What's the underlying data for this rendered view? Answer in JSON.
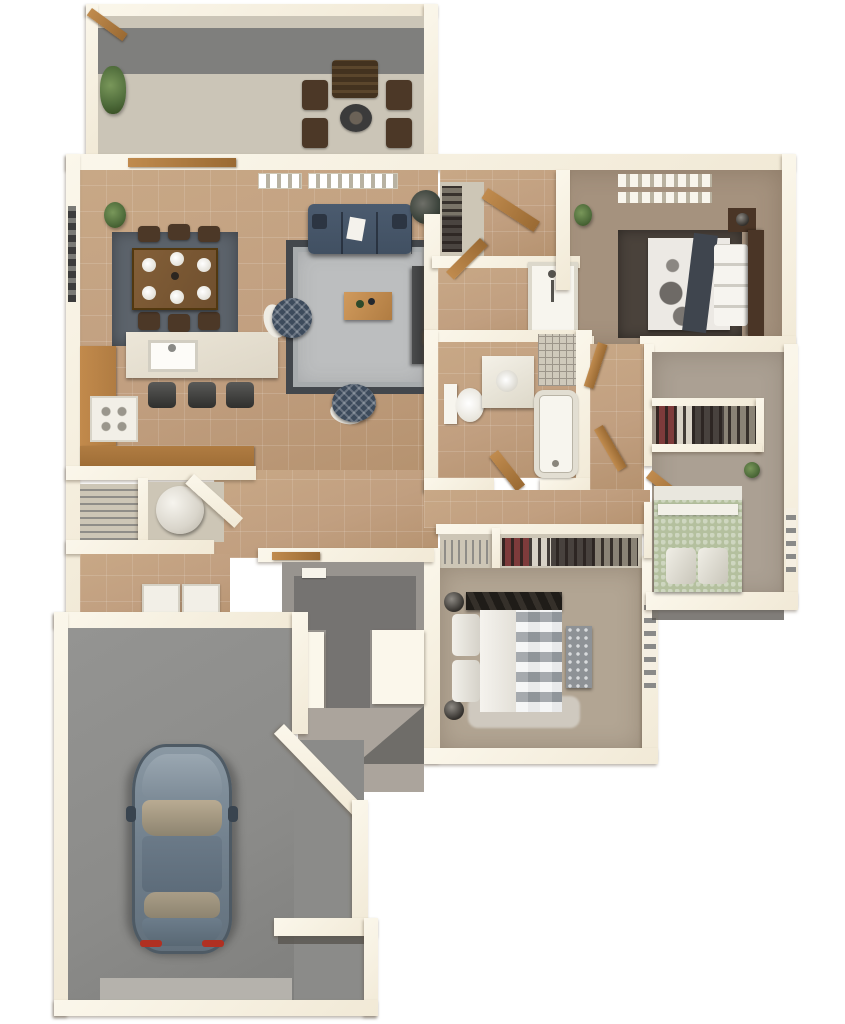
{
  "meta": {
    "kind": "3d-floor-plan-render",
    "view": "top-down isometric",
    "text_visible_on_image": "none"
  },
  "palette": {
    "wall": "#f1e9d6",
    "wall_hi": "#fbf7eb",
    "tile": "#c19f80",
    "rug_dining": "#5c636b",
    "table_wood": "#6f4f2e",
    "rug_living": "#bcbebf",
    "rug_living_border": "#43474c",
    "sofa": "#415062",
    "ottoman": "#3d4b5c",
    "counter_wood": "#b07c42",
    "island": "#ddd6c6",
    "carpet_master": "#a5927e",
    "rug_master": "#4a423b",
    "bed_frame": "#4a3526",
    "carpet_bed2": "#b2a593",
    "carpet_bed3": "#aba093",
    "bed_green": "#b4c09e",
    "bath_white": "#f7f5ee",
    "garage_floor": "#8b8b89",
    "garage_apron": "#b5b2ac",
    "porch": "#98948f",
    "porch_dark": "#757371",
    "porch_slab": "#aba49c",
    "patio": "#cbc5b7",
    "patio_band": "#7f7f7d",
    "car_body": "#73828f",
    "car_glass": "#b9ab92",
    "plant": "#4e6b3a"
  },
  "rooms": [
    {
      "id": "patio",
      "name": "Rear patio",
      "furniture": [
        "outdoor-chair x4",
        "outdoor-loveseat",
        "fire-pit",
        "potted-plant"
      ]
    },
    {
      "id": "dining",
      "name": "Dining area",
      "furniture": [
        "dining-table",
        "dining-chair x6",
        "place-setting x6",
        "area-rug"
      ]
    },
    {
      "id": "kitchen",
      "name": "Kitchen",
      "furniture": [
        "l-shaped-counter",
        "island-with-sink",
        "range",
        "bar-stool x3"
      ]
    },
    {
      "id": "living",
      "name": "Living room",
      "furniture": [
        "sofa",
        "area-rug",
        "coffee-table",
        "round-ottoman x2",
        "media-console",
        "potted-plant",
        "window x2"
      ]
    },
    {
      "id": "utility",
      "name": "Utility / laundry",
      "furniture": [
        "wire-pantry",
        "water-heater",
        "washer",
        "dryer"
      ]
    },
    {
      "id": "master-suite",
      "name": "Master bedroom suite",
      "furniture": [
        "bed",
        "nightstand x2",
        "lamp x2",
        "area-rug",
        "window x2",
        "walk-in-closet",
        "shower",
        "potted-plant"
      ]
    },
    {
      "id": "hall-bath",
      "name": "Hall bathroom",
      "furniture": [
        "toilet",
        "vanity-sink",
        "bathtub",
        "tiled-shower"
      ]
    },
    {
      "id": "bedroom-2",
      "name": "Bedroom 2 (bottom)",
      "furniture": [
        "bed",
        "foot-bench",
        "lamp x2",
        "closet x2",
        "window"
      ]
    },
    {
      "id": "bedroom-3",
      "name": "Bedroom 3 (right)",
      "furniture": [
        "bed",
        "closet",
        "window",
        "potted-plant"
      ]
    },
    {
      "id": "entry-porch",
      "name": "Covered entry porch",
      "furniture": []
    },
    {
      "id": "garage",
      "name": "Garage",
      "furniture": [
        "car",
        "garage-door-apron"
      ]
    }
  ]
}
